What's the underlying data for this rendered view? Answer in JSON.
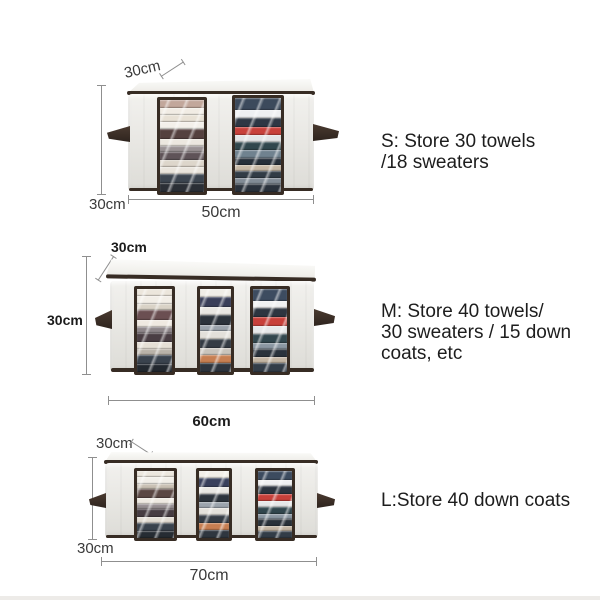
{
  "colors": {
    "trim": "#372c24",
    "dim": "#8f8f8f",
    "fabric": "#e9e8e4",
    "red_accent": "#c8413b",
    "text": "#1d1d1d"
  },
  "sections": [
    {
      "name": "S",
      "label_depth": "30cm",
      "label_height": "30cm",
      "label_width": "50cm",
      "description_lines": [
        "S: Store 30 towels",
        "/18 sweaters"
      ],
      "windows": [
        {
          "stripes": [
            [
              "#c2a79b",
              7
            ],
            [
              "#f1ece4",
              6
            ],
            [
              "#e8e1d5",
              6
            ],
            [
              "#f3f0ea",
              6
            ],
            [
              "#55413f",
              9
            ],
            [
              "#ece7df",
              6
            ],
            [
              "#9a9294",
              5
            ],
            [
              "#5f5358",
              7
            ],
            [
              "#ddd6cb",
              6
            ],
            [
              "#e9e4dc",
              6
            ],
            [
              "#3c4550",
              8
            ],
            [
              "#2b2f36",
              8
            ]
          ]
        },
        {
          "stripes": [
            [
              "#3c4a5c",
              10
            ],
            [
              "#eef0f2",
              7
            ],
            [
              "#2e3744",
              7
            ],
            [
              "#c8413b",
              7
            ],
            [
              "#e3e5e6",
              6
            ],
            [
              "#31474d",
              7
            ],
            [
              "#70828f",
              6
            ],
            [
              "#27303a",
              6
            ],
            [
              "#c7b9a6",
              5
            ],
            [
              "#323c46",
              6
            ],
            [
              "#818b95",
              5
            ],
            [
              "#2a323c",
              7
            ]
          ]
        }
      ]
    },
    {
      "name": "M",
      "label_depth": "30cm",
      "label_height": "30cm",
      "label_width": "60cm",
      "description_lines": [
        "M: Store 40 towels/",
        "30 sweaters / 15 down",
        "coats, etc"
      ],
      "windows": [
        {
          "stripes": [
            [
              "#ece6dc",
              6
            ],
            [
              "#f2eee7",
              6
            ],
            [
              "#d9d2c6",
              5
            ],
            [
              "#6b4f52",
              8
            ],
            [
              "#efe9e1",
              6
            ],
            [
              "#8d8589",
              5
            ],
            [
              "#4a3e44",
              7
            ],
            [
              "#e5dfd6",
              6
            ],
            [
              "#b9b2a8",
              5
            ],
            [
              "#3a434e",
              7
            ],
            [
              "#22282f",
              7
            ]
          ]
        },
        {
          "stripes": [
            [
              "#f0ede7",
              6
            ],
            [
              "#3a3f5a",
              8
            ],
            [
              "#e8e6e2",
              6
            ],
            [
              "#2c333c",
              7
            ],
            [
              "#9aa2ab",
              5
            ],
            [
              "#e3e0da",
              6
            ],
            [
              "#343b44",
              7
            ],
            [
              "#c9c4bc",
              5
            ],
            [
              "#c77f52",
              6
            ],
            [
              "#2e353e",
              7
            ]
          ]
        },
        {
          "stripes": [
            [
              "#3d4c60",
              9
            ],
            [
              "#f0f1f2",
              6
            ],
            [
              "#2d3540",
              7
            ],
            [
              "#c8403a",
              7
            ],
            [
              "#e6e8e9",
              6
            ],
            [
              "#32474e",
              7
            ],
            [
              "#8b97a2",
              5
            ],
            [
              "#2a323c",
              6
            ],
            [
              "#c3b5a3",
              5
            ],
            [
              "#333d48",
              7
            ]
          ]
        }
      ]
    },
    {
      "name": "L",
      "label_depth": "30cm",
      "label_height": "30cm",
      "label_width": "70cm",
      "description_lines": [
        "L:Store 40 down coats"
      ],
      "windows": [
        {
          "stripes": [
            [
              "#ece7de",
              6
            ],
            [
              "#f2efe9",
              6
            ],
            [
              "#c8bfb2",
              5
            ],
            [
              "#5a4743",
              8
            ],
            [
              "#eee9e1",
              6
            ],
            [
              "#958d90",
              5
            ],
            [
              "#463c42",
              7
            ],
            [
              "#e2dcd3",
              6
            ],
            [
              "#39424d",
              7
            ],
            [
              "#262c33",
              7
            ]
          ]
        },
        {
          "stripes": [
            [
              "#f1eee8",
              6
            ],
            [
              "#39405c",
              8
            ],
            [
              "#e9e7e3",
              6
            ],
            [
              "#2d343d",
              7
            ],
            [
              "#9ba3ac",
              5
            ],
            [
              "#e4e1db",
              6
            ],
            [
              "#353c45",
              7
            ],
            [
              "#c77e51",
              6
            ],
            [
              "#2f363f",
              7
            ]
          ]
        },
        {
          "stripes": [
            [
              "#3c4b5f",
              9
            ],
            [
              "#eff0f1",
              6
            ],
            [
              "#2c343f",
              7
            ],
            [
              "#c7403a",
              7
            ],
            [
              "#e5e7e8",
              6
            ],
            [
              "#31464d",
              7
            ],
            [
              "#8a96a1",
              5
            ],
            [
              "#293139",
              6
            ],
            [
              "#c2b4a2",
              5
            ],
            [
              "#323c47",
              7
            ]
          ]
        }
      ]
    }
  ]
}
